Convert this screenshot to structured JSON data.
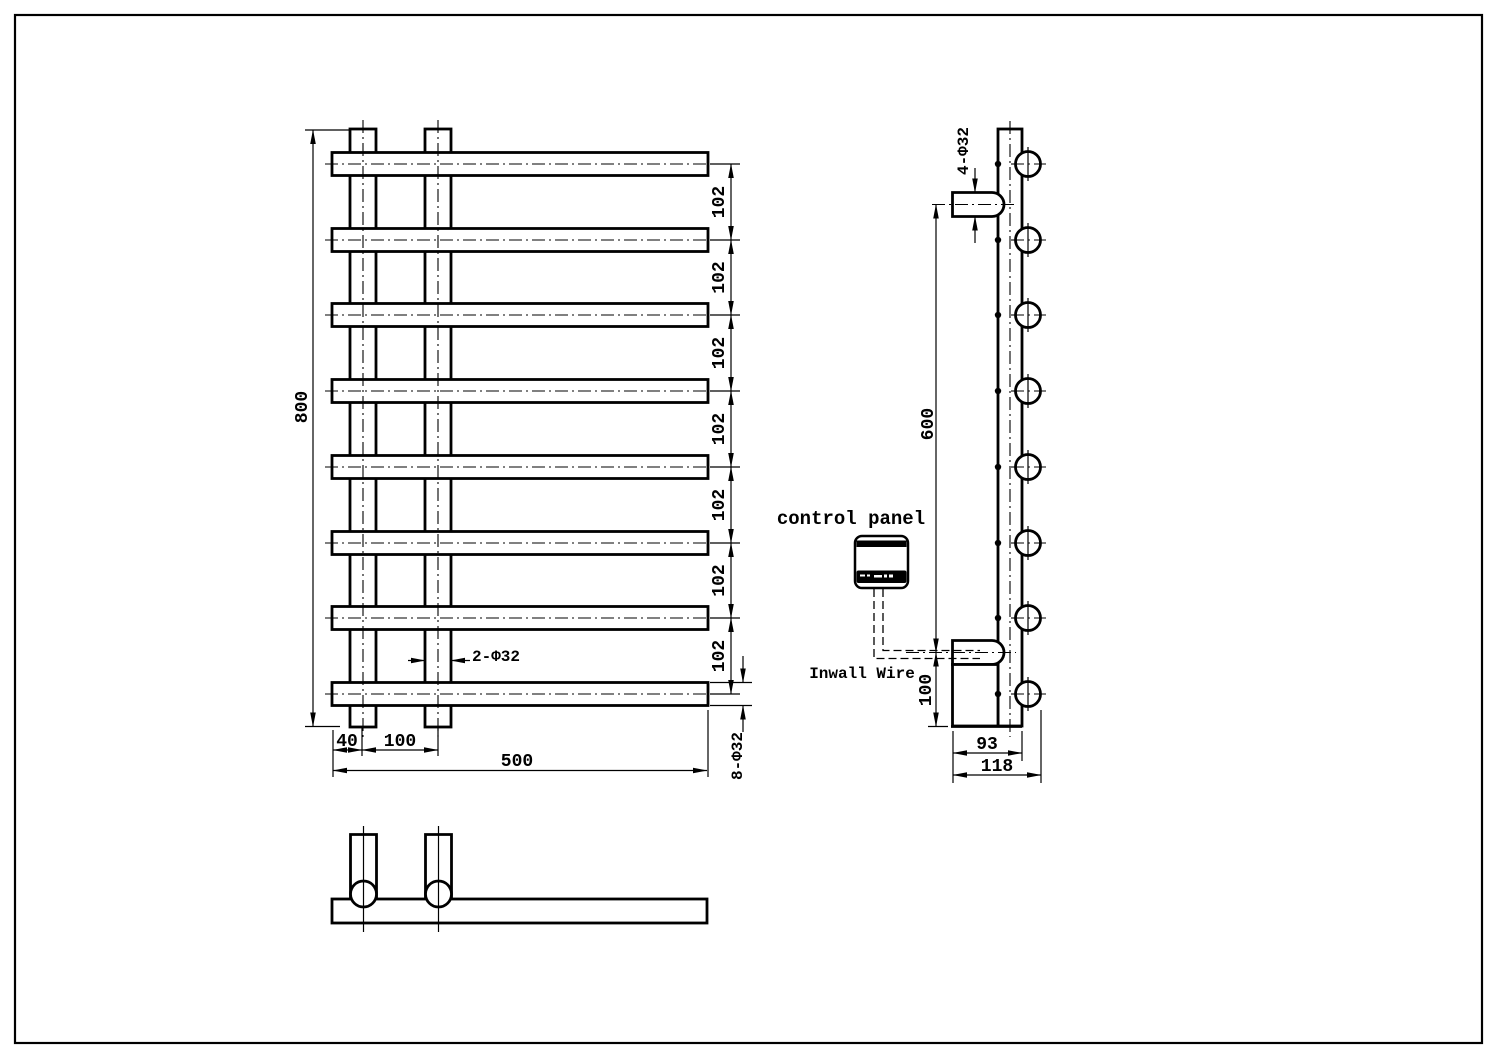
{
  "front_view": {
    "height": "800",
    "spacings": [
      "102",
      "102",
      "102",
      "102",
      "102",
      "102",
      "102"
    ],
    "post_dia": "2-Φ32",
    "edge_offset": "40",
    "post_spacing": "100",
    "width": "500",
    "bar_dia": "8-Φ32"
  },
  "side_view": {
    "stub_dia": "4-Φ32",
    "stub_spacing": "600",
    "element_height": "100",
    "depth_inner": "93",
    "depth_overall": "118"
  },
  "labels": {
    "control_panel": "control panel",
    "inwall_wire": "Inwall Wire"
  },
  "colors": {
    "line": "#000000",
    "background": "#ffffff"
  }
}
